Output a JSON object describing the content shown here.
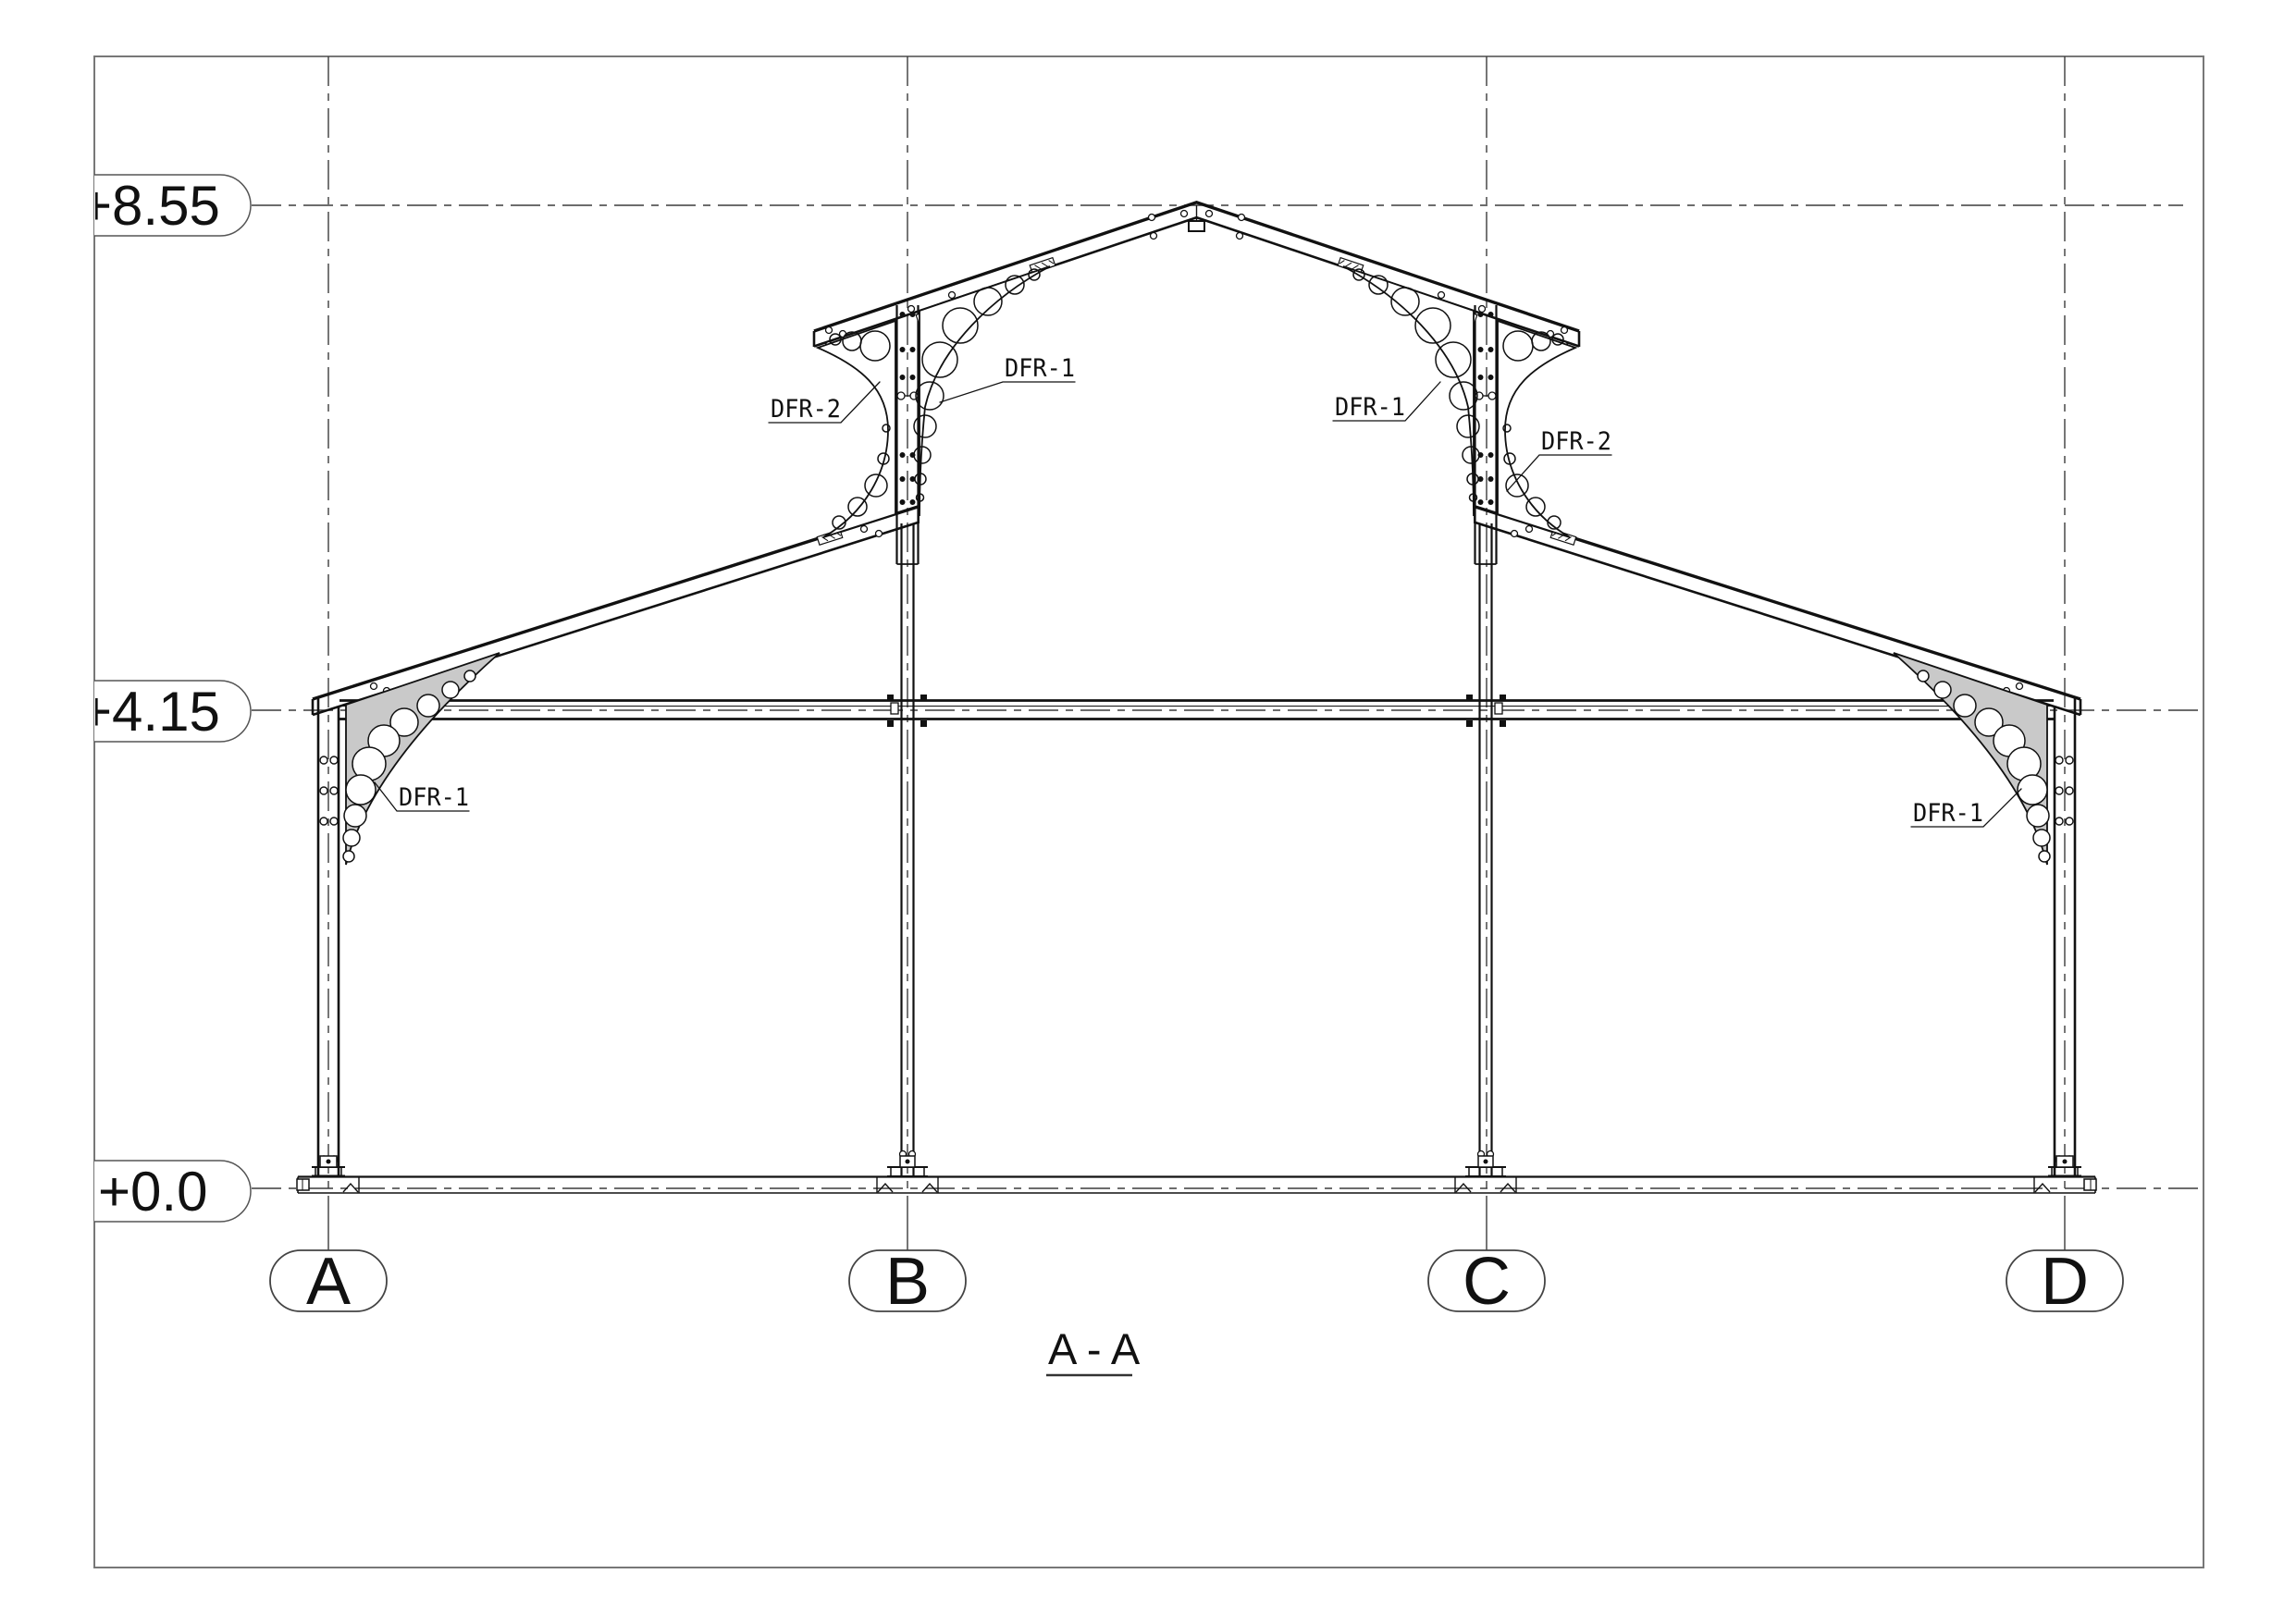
{
  "section_title": "A - A",
  "elevation_labels": [
    "+8.55",
    "+4.15",
    "+0.0"
  ],
  "grid_labels": [
    "A",
    "B",
    "C",
    "D"
  ],
  "callouts": [
    "DFR-2",
    "DFR-1",
    "DFR-1",
    "DFR-2",
    "DFR-1",
    "DFR-1"
  ]
}
